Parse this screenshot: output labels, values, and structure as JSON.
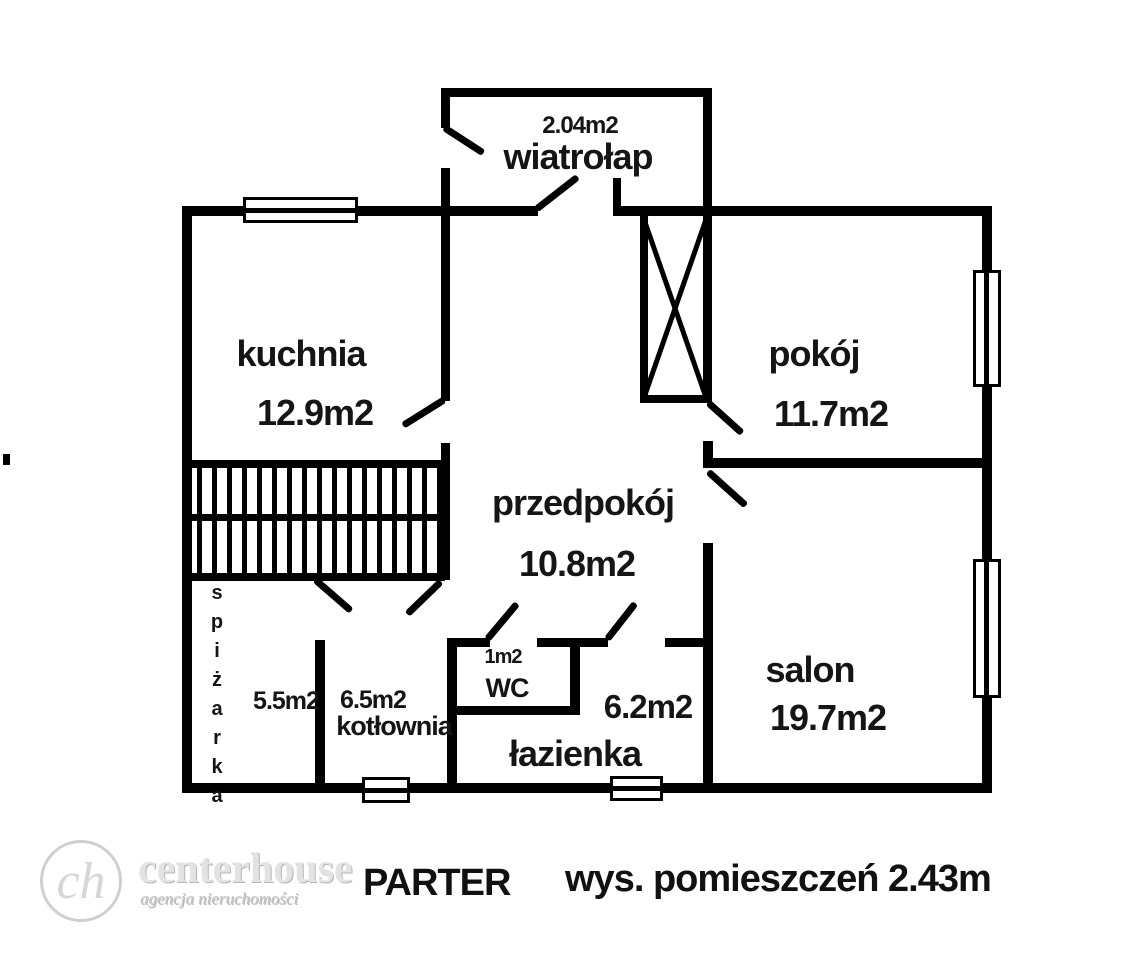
{
  "plan": {
    "floor_label": "PARTER",
    "ceiling_height_note": "wys. pomieszczeń 2.43m",
    "rooms": [
      {
        "id": "wiatrolap",
        "name": "wiatrołap",
        "area": "2.04m2"
      },
      {
        "id": "kuchnia",
        "name": "kuchnia",
        "area": "12.9m2"
      },
      {
        "id": "pokoj",
        "name": "pokój",
        "area": "11.7m2"
      },
      {
        "id": "przedpokoj",
        "name": "przedpokój",
        "area": "10.8m2"
      },
      {
        "id": "spizarka",
        "name": "spiżarka",
        "area": "5.5m2"
      },
      {
        "id": "kotlownia",
        "name": "kotłownia",
        "area": "6.5m2"
      },
      {
        "id": "wc",
        "name": "WC",
        "area": "1m2"
      },
      {
        "id": "lazienka",
        "name": "łazienka",
        "area": "6.2m2"
      },
      {
        "id": "salon",
        "name": "salon",
        "area": "19.7m2"
      }
    ],
    "logo": {
      "monogram": "ch",
      "brand": "centerhouse",
      "tagline": "agencja nieruchomości"
    },
    "colors": {
      "walls": "#000000",
      "text": "#151515",
      "logo": "#d0d0d0",
      "background": "#ffffff"
    }
  }
}
